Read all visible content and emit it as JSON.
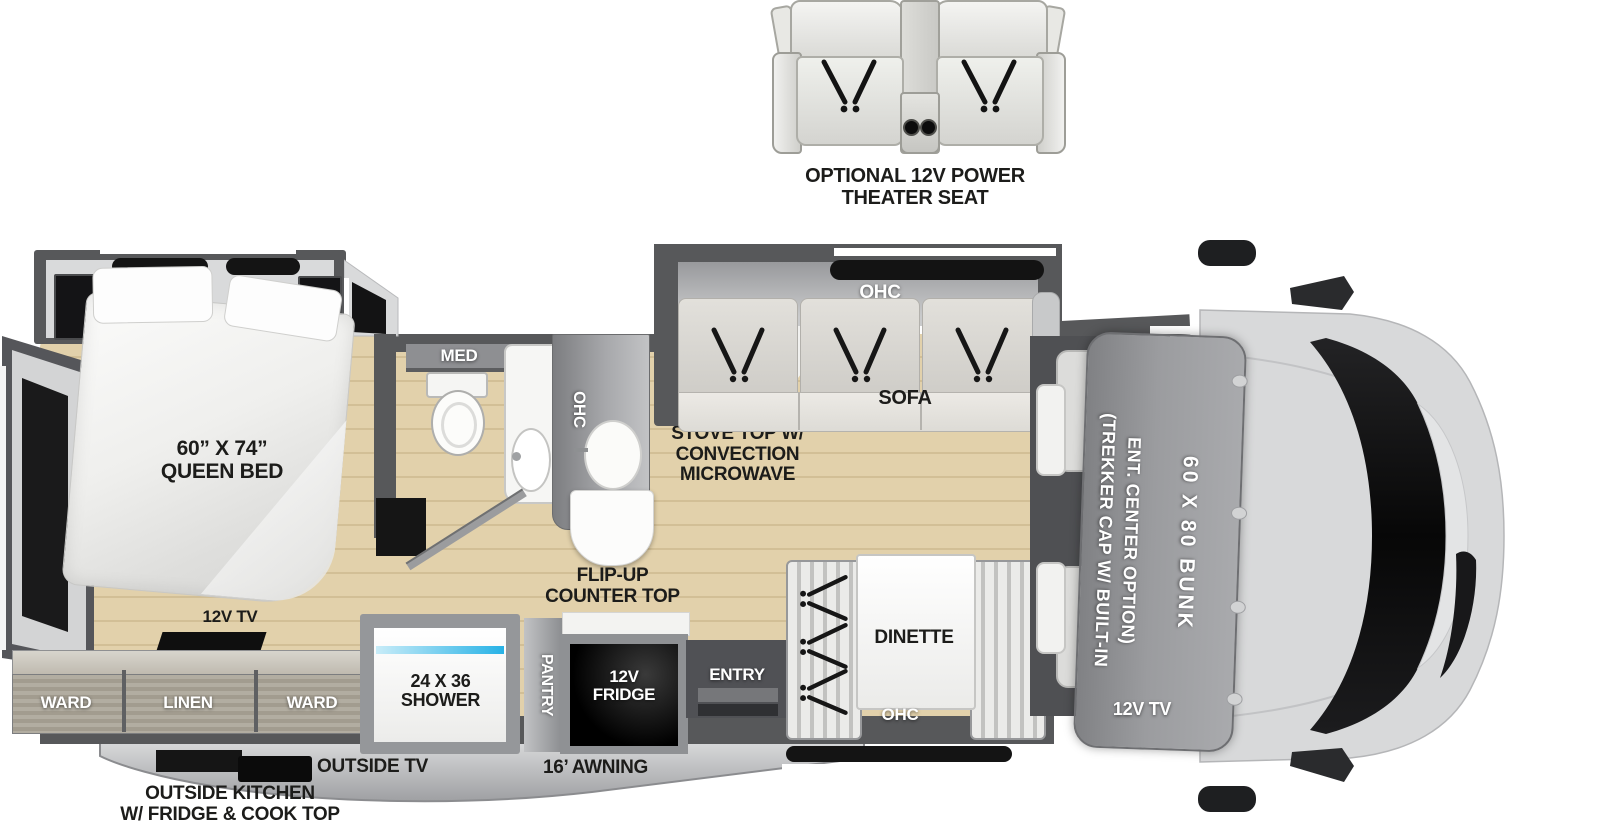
{
  "theater_seat": {
    "label_line1": "OPTIONAL 12V POWER",
    "label_line2": "THEATER SEAT"
  },
  "bedroom": {
    "bed_size": "60” X 74”",
    "bed_name": "QUEEN BED",
    "tv": "12V TV",
    "ward_left": "WARD",
    "linen": "LINEN",
    "ward_right": "WARD"
  },
  "bathroom": {
    "med": "MED"
  },
  "kitchen": {
    "ohc": "OHC",
    "stove_line1": "STOVE TOP W/",
    "stove_line2": "CONVECTION",
    "stove_line3": "MICROWAVE",
    "flip_line1": "FLIP-UP",
    "flip_line2": "COUNTER TOP"
  },
  "living": {
    "sofa_ohc": "OHC",
    "sofa": "SOFA",
    "dinette": "DINETTE",
    "dinette_ohc": "OHC",
    "entry": "ENTRY"
  },
  "utility": {
    "shower_line1": "24 X 36",
    "shower_line2": "SHOWER",
    "pantry": "PANTRY",
    "fridge_line1": "12V",
    "fridge_line2": "FRIDGE"
  },
  "front": {
    "bunk": "60 X 80 BUNK",
    "option_line1": "(TREKKER CAP W/ BUILT-IN",
    "option_line2": "ENT. CENTER OPTION)",
    "tv": "12V TV"
  },
  "exterior": {
    "outside_tv": "OUTSIDE TV",
    "awning": "16’ AWNING",
    "kitchen_line1": "OUTSIDE KITCHEN",
    "kitchen_line2": "W/ FRIDGE & COOK TOP"
  },
  "colors": {
    "wall": "#57585a",
    "floor": "#dcc9a2",
    "accent_blue": "#27b2e6",
    "black": "#141414"
  }
}
